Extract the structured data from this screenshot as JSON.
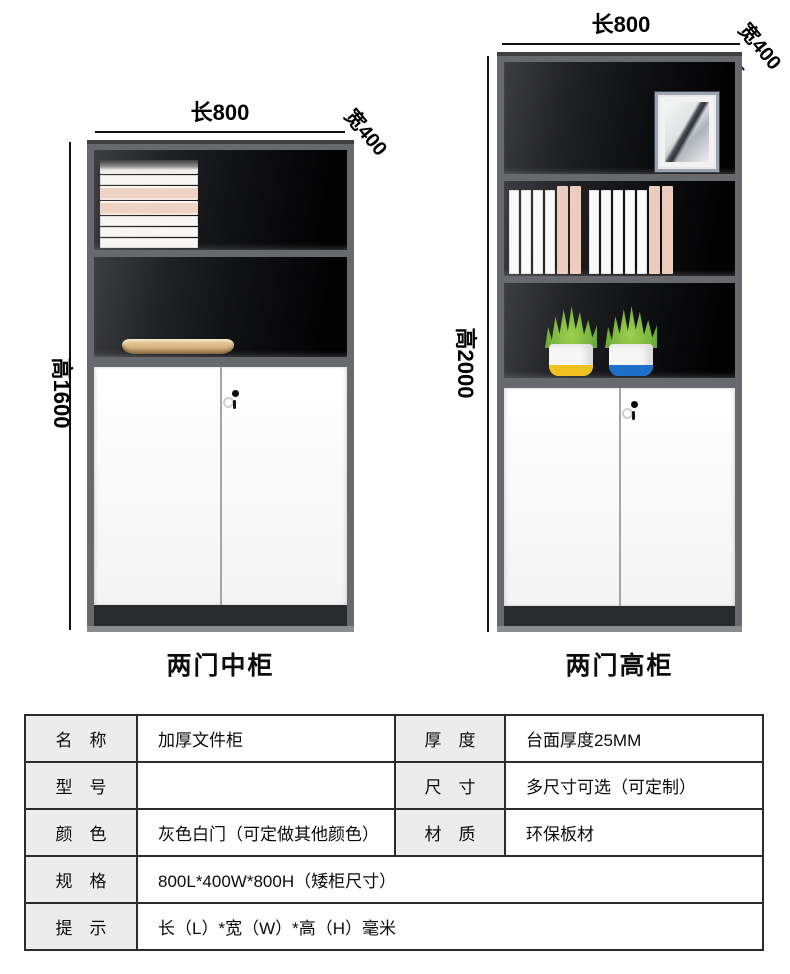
{
  "figures": {
    "left": {
      "caption": "两门中柜",
      "length_label": "长800",
      "width_label": "宽400",
      "height_label": "高1600"
    },
    "right": {
      "caption": "两门高柜",
      "length_label": "长800",
      "width_label": "宽400",
      "height_label": "高2000"
    }
  },
  "spec_table": {
    "name_label": "名　称",
    "name_value": "加厚文件柜",
    "thickness_label": "厚　度",
    "thickness_value": "台面厚度25MM",
    "model_label": "型　号",
    "model_value": "",
    "size_label": "尺　寸",
    "size_value": "多尺寸可选（可定制）",
    "color_label": "颜　色",
    "color_value": "灰色白门（可定做其他颜色）",
    "material_label": "材　质",
    "material_value": "环保板材",
    "spec_label": "规　格",
    "spec_value": "800L*400W*800H（矮柜尺寸）",
    "tip_label": "提　示",
    "tip_value": "长（L）*宽（W）*高（H）毫米"
  },
  "colors": {
    "cabinet_frame": "#67696c",
    "cabinet_interior": "#141517",
    "door_white": "#fafafa",
    "base_dark": "#292a2c",
    "book_pink": "#eccdbd",
    "tray_wood": "#d7b483",
    "foliage_green": "#79b43e",
    "pot_band_yellow": "#f0c11e",
    "pot_band_blue": "#1e6fc8",
    "table_header_bg": "#ececec",
    "table_border": "#2c2c2c",
    "dimension_line": "#111111"
  }
}
